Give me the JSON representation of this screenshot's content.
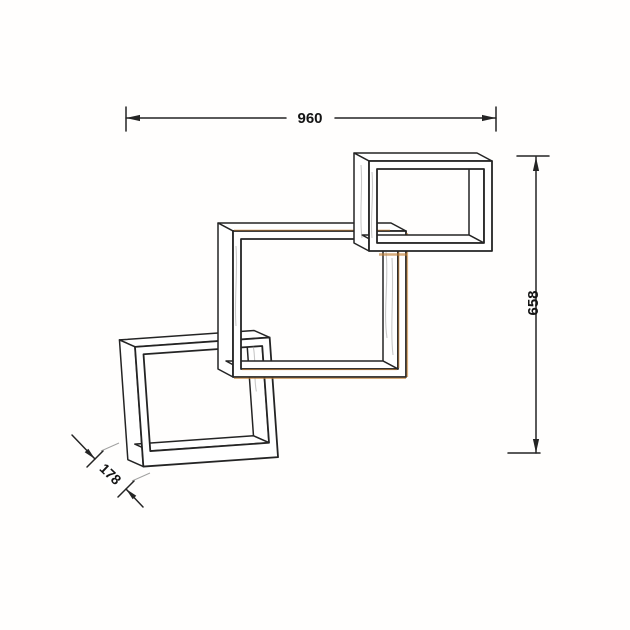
{
  "page": {
    "background": "#ffffff"
  },
  "drawing": {
    "type": "technical-line-drawing",
    "subject": "three interlocking wall cube shelves",
    "dimensions": {
      "width": {
        "value": "960"
      },
      "height": {
        "value": "658"
      },
      "depth": {
        "value": "178"
      }
    },
    "colors": {
      "line": "#242424",
      "accent": "#c17f36",
      "shading": "#9a9a9a"
    }
  }
}
